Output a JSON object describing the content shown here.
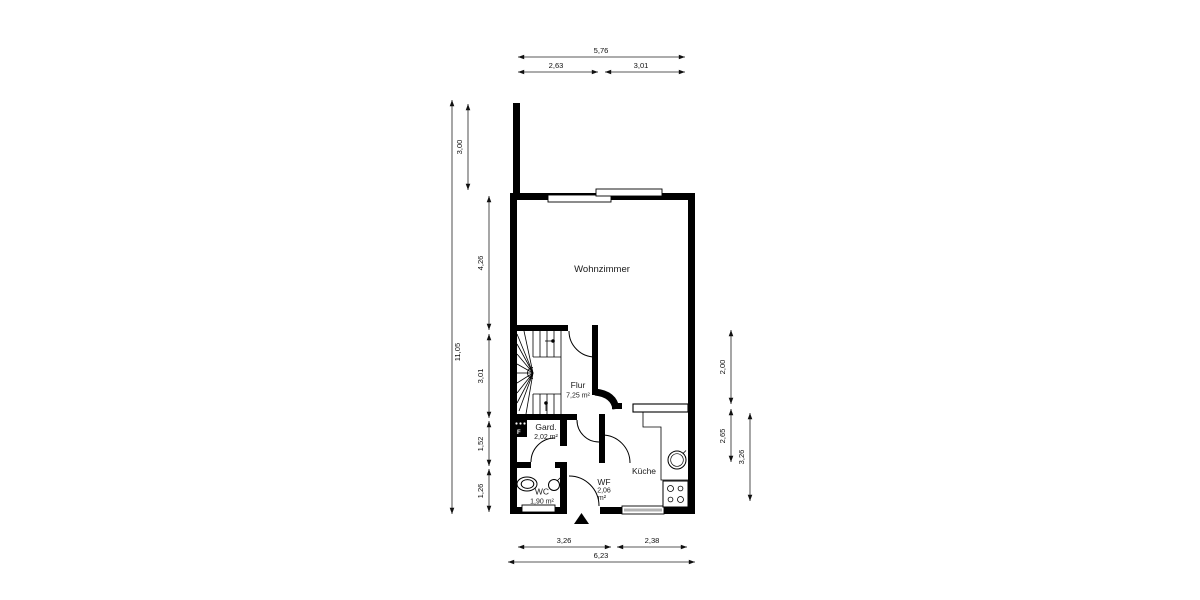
{
  "plan": {
    "rooms": {
      "wohnzimmer": {
        "name": "Wohnzimmer"
      },
      "flur": {
        "name": "Flur",
        "area": "7,25 m²"
      },
      "gard": {
        "name": "Gard.",
        "area": "2,02 m²"
      },
      "wc": {
        "name": "WC",
        "area": "1,90 m²"
      },
      "wf": {
        "name": "WF",
        "area_value": "2,06",
        "area_unit": "m²"
      },
      "kueche": {
        "name": "Küche"
      }
    },
    "chimney": {
      "label": "F"
    },
    "dims": {
      "top": {
        "total": "5,76",
        "left": "2,63",
        "right": "3,01"
      },
      "left": {
        "stub": "3,00",
        "total": "11,05",
        "upper": "4,26",
        "middle": "3,01",
        "lower": "1,52",
        "bottom": "1,26"
      },
      "right": {
        "upper": "2,00",
        "middle": "2,65",
        "outer": "3,26"
      },
      "bottom": {
        "left": "3,26",
        "right": "2,38",
        "total": "6,23"
      }
    },
    "colors": {
      "wall": "#000000",
      "window_glass": "#b3b3b3",
      "background": "#ffffff"
    }
  }
}
